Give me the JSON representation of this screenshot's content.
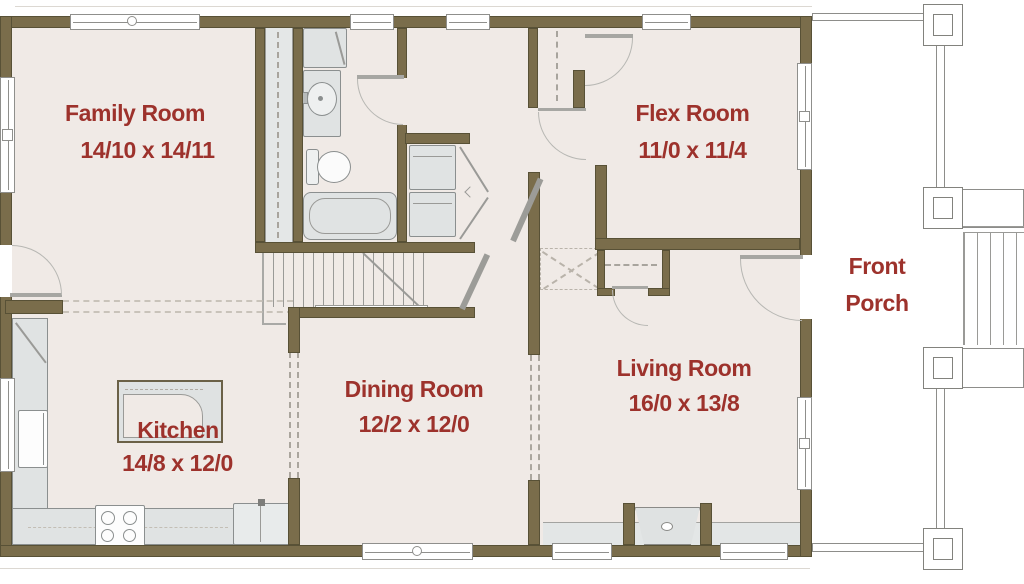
{
  "title": "First Floor Plan",
  "colors": {
    "wall": "#7a6d4b",
    "wall_edge": "#585136",
    "floor": "#f0eae6",
    "fixture_fill": "#e0e3e3",
    "fixture_line": "#8b8f8f",
    "room_label": "#9d322c",
    "porch_line": "#8d8d8a"
  },
  "rooms": [
    {
      "id": "family-room",
      "name": "Family Room",
      "dims": "14/10 x 14/11"
    },
    {
      "id": "flex-room",
      "name": "Flex Room",
      "dims": "11/0 x 11/4"
    },
    {
      "id": "front-porch",
      "line1": "Front",
      "line2": "Porch"
    },
    {
      "id": "living-room",
      "name": "Living Room",
      "dims": "16/0 x 13/8"
    },
    {
      "id": "dining-room",
      "name": "Dining Room",
      "dims": "12/2 x 12/0"
    },
    {
      "id": "kitchen",
      "name": "Kitchen",
      "dims": "14/8 x 12/0"
    }
  ],
  "fixtures": [
    "bathroom-cabinet",
    "bathroom-vanity-sink",
    "toilet",
    "bathtub",
    "washer-dryer-stack",
    "staircase",
    "stair-railing",
    "closet-rod",
    "linen-closet",
    "coat-closet",
    "kitchen-island",
    "range-stove",
    "refrigerator",
    "dishwasher",
    "kitchen-counter",
    "fireplace",
    "hearth",
    "porch-columns",
    "porch-railing",
    "porch-steps"
  ]
}
